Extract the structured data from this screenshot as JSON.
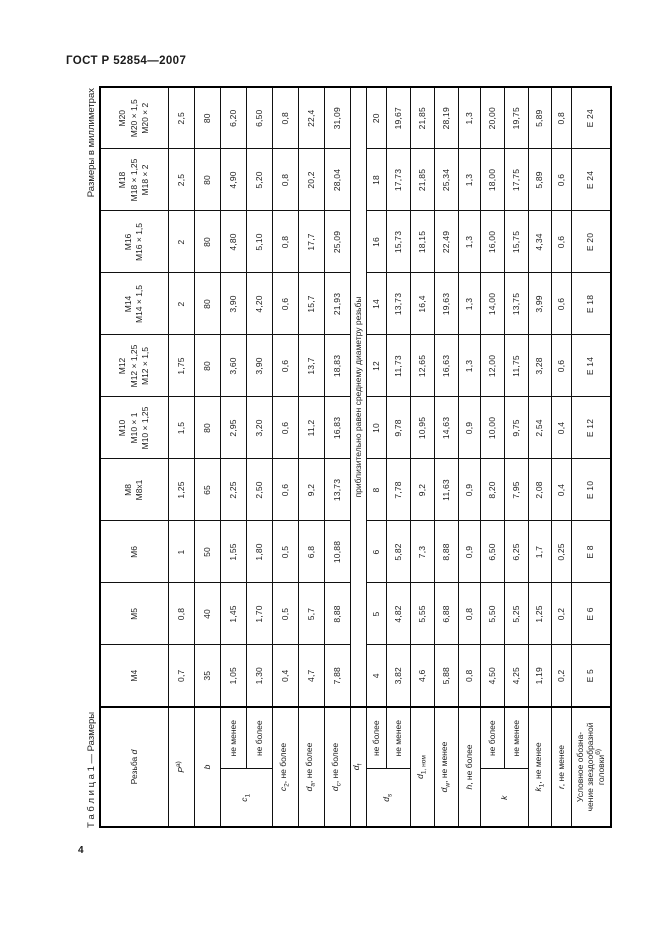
{
  "page": {
    "doc_header": "ГОСТ Р 52854—2007",
    "page_number": "4"
  },
  "captions": {
    "table_caption": "Т а б л и ц а 1 — Размеры",
    "units": "Размеры в миллиметрах"
  },
  "table": {
    "stub_header": {
      "text": "Резьба ",
      "sym": "d"
    },
    "columns": [
      {
        "lines": [
          "М4"
        ]
      },
      {
        "lines": [
          "М5"
        ]
      },
      {
        "lines": [
          "М6"
        ]
      },
      {
        "lines": [
          "М8",
          "М8х1"
        ]
      },
      {
        "lines": [
          "М10",
          "М10 × 1",
          "М10 × 1,25"
        ]
      },
      {
        "lines": [
          "М12",
          "М12 × 1,25",
          "М12 × 1,5"
        ]
      },
      {
        "lines": [
          "М14",
          "М14 × 1,5"
        ]
      },
      {
        "lines": [
          "М16",
          "М16 × 1,5"
        ]
      },
      {
        "lines": [
          "М18",
          "М18 × 1,25",
          "М18 × 2"
        ]
      },
      {
        "lines": [
          "М20",
          "М20 × 1,5",
          "М20 × 2"
        ]
      }
    ],
    "rows": {
      "P": {
        "sym": "P",
        "sup": "а)",
        "values": [
          "0,7",
          "0,8",
          "1",
          "1,25",
          "1,5",
          "1,75",
          "2",
          "2",
          "2,5",
          "2,5"
        ]
      },
      "b": {
        "sym": "b",
        "values": [
          "35",
          "40",
          "50",
          "65",
          "80",
          "80",
          "80",
          "80",
          "80",
          "80"
        ]
      },
      "c1": {
        "sym": "c",
        "sub": "1",
        "sub_rows": [
          {
            "label": "не менее",
            "values": [
              "1,05",
              "1,45",
              "1,55",
              "2,25",
              "2,95",
              "3,60",
              "3,90",
              "4,80",
              "4,90",
              "6,20"
            ]
          },
          {
            "label": "не более",
            "values": [
              "1,30",
              "1,70",
              "1,80",
              "2,50",
              "3,20",
              "3,90",
              "4,20",
              "5,10",
              "5,20",
              "6,50"
            ]
          }
        ]
      },
      "c2": {
        "sym": "c",
        "sub": "2",
        "suffix": ", не более",
        "values": [
          "0,4",
          "0,5",
          "0,5",
          "0,6",
          "0,6",
          "0,6",
          "0,6",
          "0,8",
          "0,8",
          "0,8"
        ]
      },
      "da": {
        "sym": "d",
        "sub": "a",
        "suffix": ", не более",
        "values": [
          "4,7",
          "5,7",
          "6,8",
          "9,2",
          "11,2",
          "13,7",
          "15,7",
          "17,7",
          "20,2",
          "22,4"
        ]
      },
      "dc": {
        "sym": "d",
        "sub": "c",
        "suffix": ", не более",
        "values": [
          "7,88",
          "8,88",
          "10,88",
          "13,73",
          "16,83",
          "18,83",
          "21,93",
          "25,09",
          "28,04",
          "31,09"
        ]
      },
      "df": {
        "sym": "d",
        "sub": "f",
        "note": "приблизительно равен среднему диаметру резьбы"
      },
      "ds": {
        "sym": "d",
        "sub": "s",
        "sub_rows": [
          {
            "label": "не более",
            "values": [
              "4",
              "5",
              "6",
              "8",
              "10",
              "12",
              "14",
              "16",
              "18",
              "20"
            ]
          },
          {
            "label": "не менее",
            "values": [
              "3,82",
              "4,82",
              "5,82",
              "7,78",
              "9,78",
              "11,73",
              "13,73",
              "15,73",
              "17,73",
              "19,67"
            ]
          }
        ]
      },
      "d1": {
        "sym": "d",
        "sub": "1, ном",
        "values": [
          "4,6",
          "5,55",
          "7,3",
          "9,2",
          "10,95",
          "12,65",
          "16,4",
          "18,15",
          "21,85",
          "21,85"
        ]
      },
      "dw": {
        "sym": "d",
        "sub": "w",
        "suffix": ", не менее",
        "values": [
          "5,88",
          "6,88",
          "8,88",
          "11,63",
          "14,63",
          "16,63",
          "19,63",
          "22,49",
          "25,34",
          "28,19"
        ]
      },
      "h": {
        "sym": "h",
        "suffix": ", не более",
        "values": [
          "0,8",
          "0,8",
          "0,9",
          "0,9",
          "0,9",
          "1,3",
          "1,3",
          "1,3",
          "1,3",
          "1,3"
        ]
      },
      "k": {
        "sym": "k",
        "sub_rows": [
          {
            "label": "не более",
            "values": [
              "4,50",
              "5,50",
              "6,50",
              "8,20",
              "10,00",
              "12,00",
              "14,00",
              "16,00",
              "18,00",
              "20,00"
            ]
          },
          {
            "label": "не менее",
            "values": [
              "4,25",
              "5,25",
              "6,25",
              "7,95",
              "9,75",
              "11,75",
              "13,75",
              "15,75",
              "17,75",
              "19,75"
            ]
          }
        ]
      },
      "k1": {
        "sym": "k",
        "sub": "1",
        "suffix": ", не менее",
        "values": [
          "1,19",
          "1,25",
          "1,7",
          "2,08",
          "2,54",
          "3,28",
          "3,99",
          "4,34",
          "5,89",
          "5,89"
        ]
      },
      "r": {
        "sym": "r",
        "suffix": ", не менее",
        "values": [
          "0,2",
          "0,2",
          "0,25",
          "0,4",
          "0,4",
          "0,6",
          "0,6",
          "0,6",
          "0,6",
          "0,8"
        ]
      },
      "e": {
        "lines": [
          "Условное обозна-",
          "чение звездообразной",
          "головки"
        ],
        "sup": "б)",
        "values": [
          "Е 5",
          "Е 6",
          "Е 8",
          "Е 10",
          "Е 12",
          "Е 14",
          "Е 18",
          "Е 20",
          "Е 24",
          "Е 24"
        ]
      }
    }
  }
}
